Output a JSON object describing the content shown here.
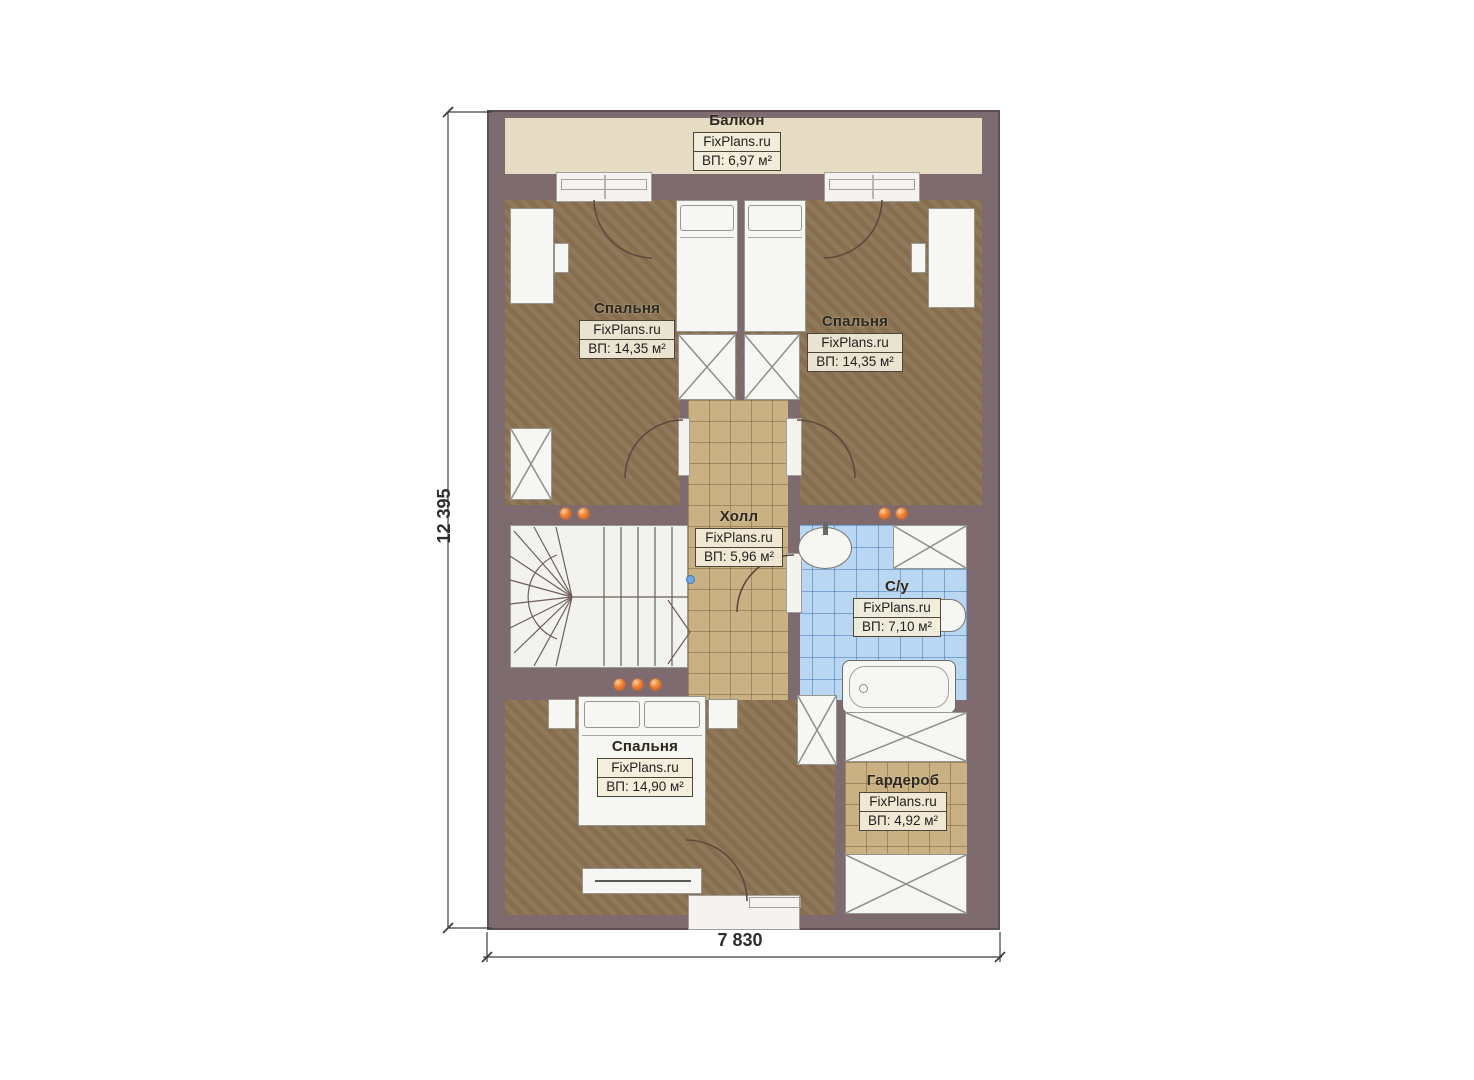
{
  "site": "FixPlans.ru",
  "dimensions": {
    "height": "12 395",
    "width": "7 830"
  },
  "rooms": [
    {
      "key": "balcony",
      "name": "Балкон",
      "brand": "FixPlans.ru",
      "area": "ВП: 6,97 м²"
    },
    {
      "key": "bedroom-left",
      "name": "Спальня",
      "brand": "FixPlans.ru",
      "area": "ВП: 14,35 м²"
    },
    {
      "key": "bedroom-right",
      "name": "Спальня",
      "brand": "FixPlans.ru",
      "area": "ВП: 14,35 м²"
    },
    {
      "key": "hall",
      "name": "Холл",
      "brand": "FixPlans.ru",
      "area": "ВП: 5,96 м²"
    },
    {
      "key": "bathroom",
      "name": "С/у",
      "brand": "FixPlans.ru",
      "area": "ВП: 7,10 м²"
    },
    {
      "key": "bedroom-bottom",
      "name": "Спальня",
      "brand": "FixPlans.ru",
      "area": "ВП: 14,90 м²"
    },
    {
      "key": "wardrobe",
      "name": "Гардероб",
      "brand": "FixPlans.ru",
      "area": "ВП: 4,92 м²"
    }
  ],
  "colors": {
    "wall": "#7d6b6f",
    "floor_wood": "#8b7353",
    "balcony_floor": "#e6dcc4",
    "tile_beige": "#c9b183",
    "tile_blue": "#b9d7f2",
    "furniture_white": "#f6f6f3",
    "accent_orange": "#ee7a2e",
    "linework": "#5d4a3f"
  }
}
